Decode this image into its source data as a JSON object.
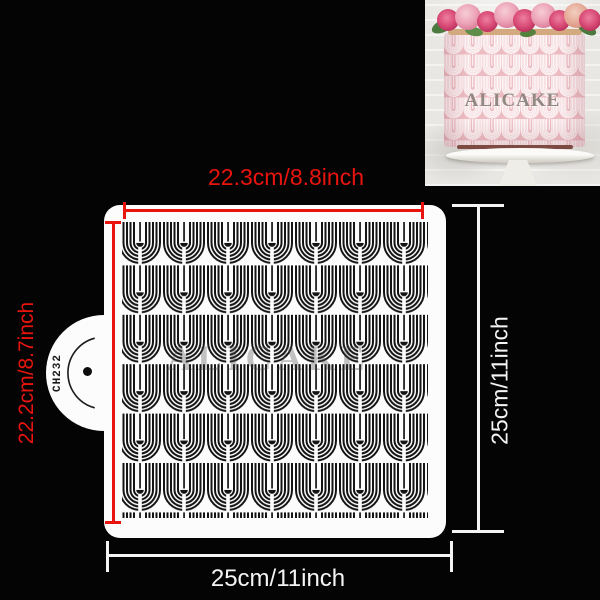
{
  "inset_photo": {
    "watermark": "ALICAKE"
  },
  "stencil": {
    "code": "CH232",
    "watermark": "ALICAKE"
  },
  "dimensions": {
    "top": "22.3cm/8.8inch",
    "left": "22.2cm/8.7inch",
    "right": "25cm/11inch",
    "bottom": "25cm/11inch"
  },
  "colors": {
    "background": "#040404",
    "dimension_red": "#e8140d",
    "dimension_white": "#f4f4f4",
    "stencil_white": "#fcfcfc",
    "pattern_black": "#141414",
    "cake_pink": "#ecbcc2"
  }
}
